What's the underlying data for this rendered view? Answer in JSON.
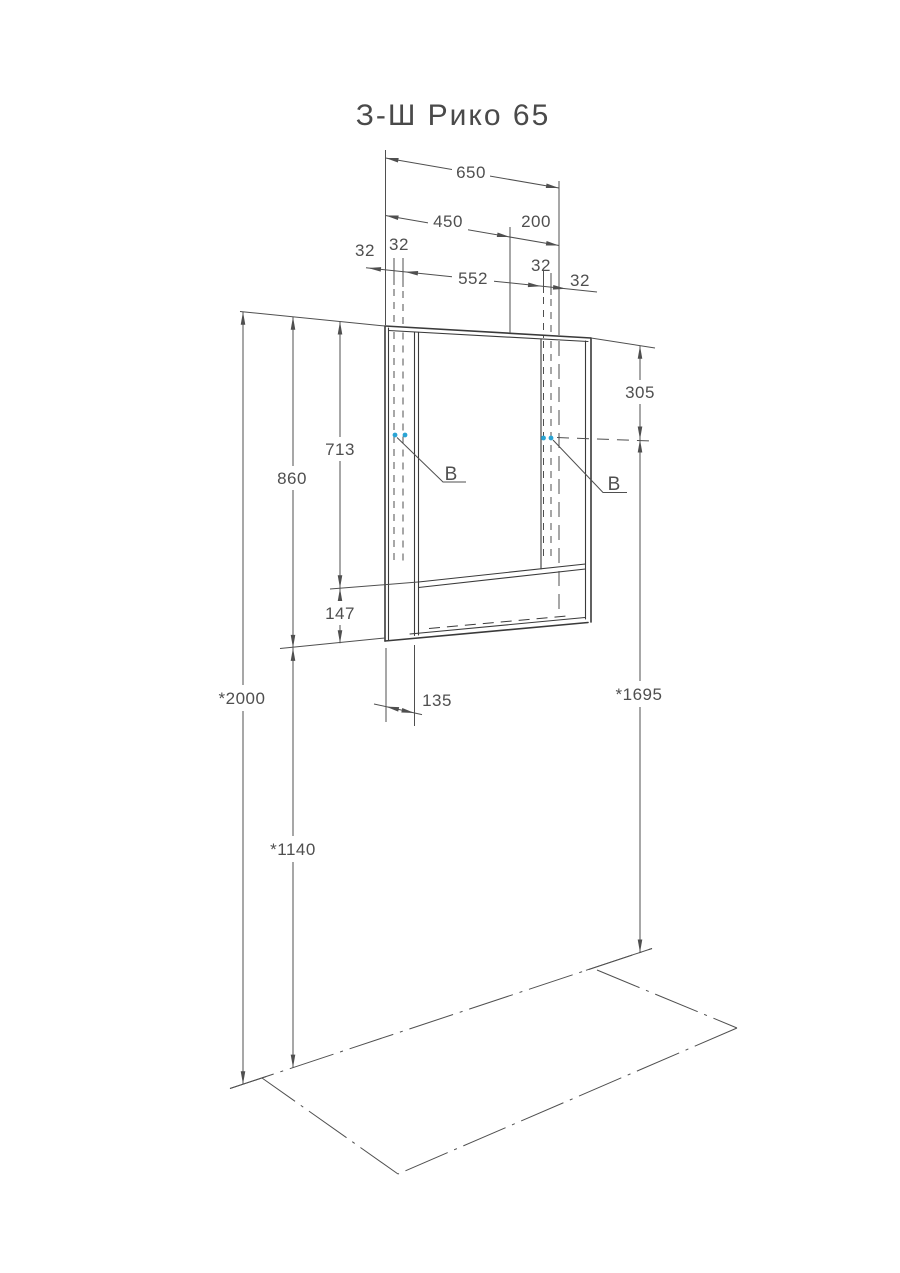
{
  "title": "З-Ш Рико 65",
  "drawing": {
    "top_dims": {
      "width_total": "650",
      "width_door": "450",
      "width_open": "200",
      "width_inner": "552",
      "offset_left_1": "32",
      "offset_left_2": "32",
      "offset_right_1": "32",
      "offset_right_2": "32"
    },
    "left_dims": {
      "cabinet_height": "860",
      "door_height": "713",
      "shelf_height": "147",
      "floor_to_top": "*2000",
      "floor_to_bottom": "*1140"
    },
    "right_dims": {
      "top_to_mount": "305",
      "floor_to_mount": "*1695"
    },
    "depth_dim": "135",
    "mount_label_left": "B",
    "mount_label_right": "B"
  },
  "colors": {
    "line": "#3a3a3a",
    "dim": "#4f4f4f",
    "accent": "#2aa4d4",
    "background": "#ffffff"
  }
}
